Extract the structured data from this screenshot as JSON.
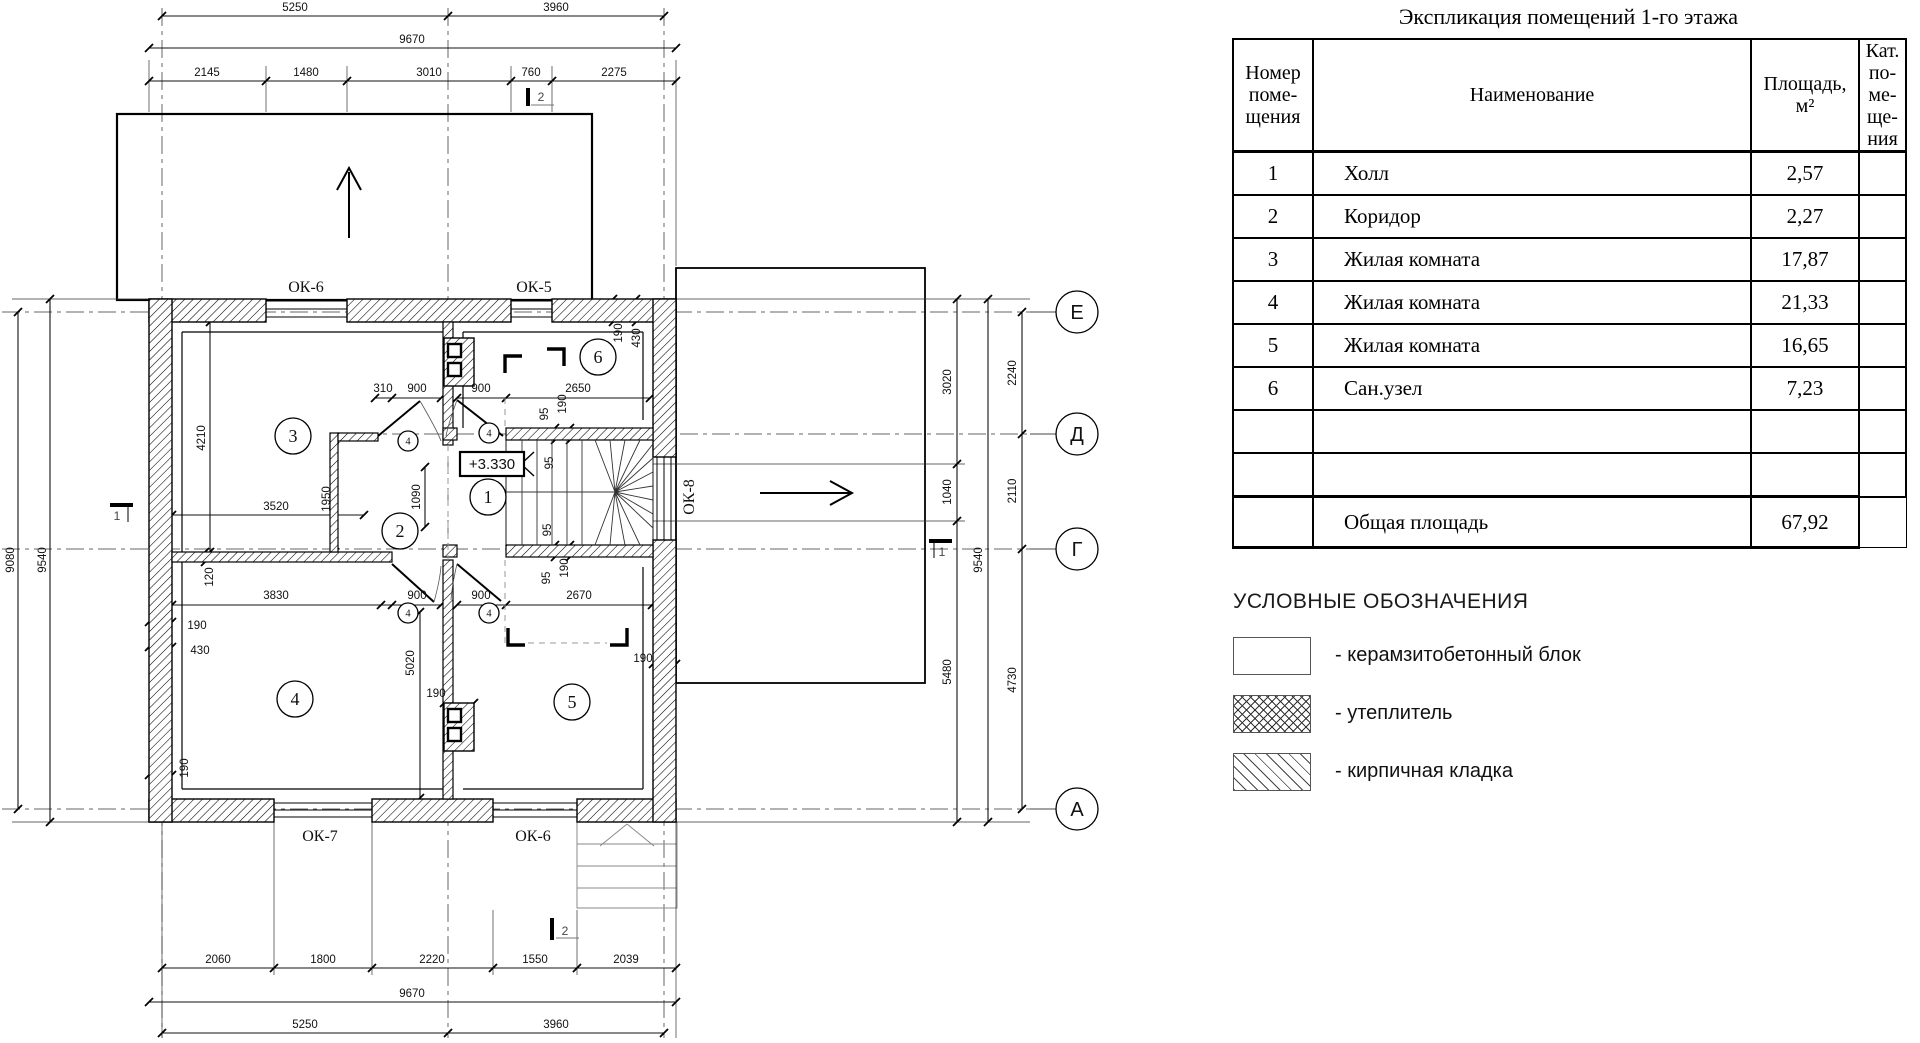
{
  "spec": {
    "title": "Экспликация помещений 1-го этажа",
    "headers": {
      "num": [
        "Номер",
        "поме-",
        "щения"
      ],
      "name": [
        "Наименование"
      ],
      "area": [
        "Площадь,",
        "м²"
      ],
      "cat": [
        "Кат.",
        "по-",
        "ме-",
        "ще-",
        "ния"
      ]
    },
    "rows": [
      {
        "num": "1",
        "name": "Холл",
        "area": "2,57",
        "cat": ""
      },
      {
        "num": "2",
        "name": "Коридор",
        "area": "2,27",
        "cat": ""
      },
      {
        "num": "3",
        "name": "Жилая комната",
        "area": "17,87",
        "cat": ""
      },
      {
        "num": "4",
        "name": "Жилая комната",
        "area": "21,33",
        "cat": ""
      },
      {
        "num": "5",
        "name": "Жилая комната",
        "area": "16,65",
        "cat": ""
      },
      {
        "num": "6",
        "name": "Сан.узел",
        "area": "7,23",
        "cat": ""
      },
      {
        "num": "",
        "name": "",
        "area": "",
        "cat": ""
      },
      {
        "num": "",
        "name": "",
        "area": "",
        "cat": ""
      }
    ],
    "total": {
      "label": "Общая площадь",
      "area": "67,92"
    }
  },
  "legend": {
    "title": "УСЛОВНЫЕ ОБОЗНАЧЕНИЯ",
    "items": [
      {
        "pattern": "plain",
        "label": "- керамзитобетонный блок"
      },
      {
        "pattern": "crosshatch",
        "label": "- утеплитель"
      },
      {
        "pattern": "diagonal",
        "label": "- кирпичная кладка"
      }
    ]
  },
  "plan": {
    "level_mark": {
      "text": "+3.330",
      "x": 492,
      "y": 469
    },
    "window_labels": [
      {
        "text": "ОК-6",
        "x": 306,
        "y": 292,
        "rot": 0
      },
      {
        "text": "ОК-5",
        "x": 534,
        "y": 292,
        "rot": 0
      },
      {
        "text": "ОК-7",
        "x": 320,
        "y": 841,
        "rot": 0
      },
      {
        "text": "ОК-6",
        "x": 533,
        "y": 841,
        "rot": 0
      },
      {
        "text": "ОК-8",
        "x": 694,
        "y": 497,
        "rot": -90
      }
    ],
    "room_circles": [
      {
        "n": "1",
        "x": 488,
        "y": 497
      },
      {
        "n": "2",
        "x": 400,
        "y": 531
      },
      {
        "n": "3",
        "x": 293,
        "y": 436
      },
      {
        "n": "4",
        "x": 295,
        "y": 699
      },
      {
        "n": "5",
        "x": 572,
        "y": 702
      },
      {
        "n": "6",
        "x": 598,
        "y": 357
      }
    ],
    "door_circles": [
      {
        "n": "4",
        "x": 408,
        "y": 441
      },
      {
        "n": "4",
        "x": 489,
        "y": 433
      },
      {
        "n": "4",
        "x": 408,
        "y": 613
      },
      {
        "n": "4",
        "x": 489,
        "y": 613
      }
    ],
    "axis_circles": [
      {
        "label": "Е",
        "x": 1077,
        "y": 312
      },
      {
        "label": "Д",
        "x": 1077,
        "y": 434
      },
      {
        "label": "Г",
        "x": 1077,
        "y": 549
      },
      {
        "label": "А",
        "x": 1077,
        "y": 809
      }
    ],
    "section_marks": [
      {
        "n": "2",
        "x": 541,
        "y": 101
      },
      {
        "n": "2",
        "x": 565,
        "y": 935
      },
      {
        "n": "1",
        "x": 117,
        "y": 520
      },
      {
        "n": "1",
        "x": 942,
        "y": 556
      }
    ],
    "dim_labels": [
      {
        "t": "5250",
        "x": 295,
        "y": 11
      },
      {
        "t": "3960",
        "x": 556,
        "y": 11
      },
      {
        "t": "9670",
        "x": 412,
        "y": 43
      },
      {
        "t": "2145",
        "x": 207,
        "y": 76
      },
      {
        "t": "1480",
        "x": 306,
        "y": 76
      },
      {
        "t": "3010",
        "x": 429,
        "y": 76
      },
      {
        "t": "760",
        "x": 531,
        "y": 76
      },
      {
        "t": "2275",
        "x": 614,
        "y": 76
      },
      {
        "t": "2060",
        "x": 218,
        "y": 963
      },
      {
        "t": "1800",
        "x": 323,
        "y": 963
      },
      {
        "t": "2220",
        "x": 432,
        "y": 963
      },
      {
        "t": "1550",
        "x": 535,
        "y": 963
      },
      {
        "t": "2039",
        "x": 626,
        "y": 963
      },
      {
        "t": "9670",
        "x": 412,
        "y": 997
      },
      {
        "t": "5250",
        "x": 305,
        "y": 1028
      },
      {
        "t": "3960",
        "x": 556,
        "y": 1028
      },
      {
        "t": "9080",
        "x": 14,
        "y": 560,
        "r": -90
      },
      {
        "t": "9540",
        "x": 46,
        "y": 560,
        "r": -90
      },
      {
        "t": "3020",
        "x": 951,
        "y": 382,
        "r": -90
      },
      {
        "t": "1040",
        "x": 951,
        "y": 492,
        "r": -90
      },
      {
        "t": "5480",
        "x": 951,
        "y": 672,
        "r": -90
      },
      {
        "t": "9540",
        "x": 982,
        "y": 560,
        "r": -90
      },
      {
        "t": "2240",
        "x": 1016,
        "y": 373,
        "r": -90
      },
      {
        "t": "2110",
        "x": 1016,
        "y": 491,
        "r": -90
      },
      {
        "t": "4730",
        "x": 1016,
        "y": 680,
        "r": -90
      },
      {
        "t": "4210",
        "x": 205,
        "y": 438,
        "r": -90
      },
      {
        "t": "3520",
        "x": 276,
        "y": 510
      },
      {
        "t": "1950",
        "x": 330,
        "y": 499,
        "r": -90
      },
      {
        "t": "120",
        "x": 213,
        "y": 577,
        "r": -90
      },
      {
        "t": "310",
        "x": 383,
        "y": 392
      },
      {
        "t": "900",
        "x": 417,
        "y": 392
      },
      {
        "t": "900",
        "x": 481,
        "y": 392
      },
      {
        "t": "2650",
        "x": 578,
        "y": 392
      },
      {
        "t": "1090",
        "x": 420,
        "y": 497,
        "r": -90
      },
      {
        "t": "3830",
        "x": 276,
        "y": 599
      },
      {
        "t": "900",
        "x": 417,
        "y": 599
      },
      {
        "t": "900",
        "x": 481,
        "y": 599
      },
      {
        "t": "2670",
        "x": 579,
        "y": 599
      },
      {
        "t": "5020",
        "x": 414,
        "y": 663,
        "r": -90
      },
      {
        "t": "190",
        "x": 436,
        "y": 697
      },
      {
        "t": "190",
        "x": 197,
        "y": 629
      },
      {
        "t": "430",
        "x": 200,
        "y": 654
      },
      {
        "t": "190",
        "x": 188,
        "y": 768,
        "r": -90
      },
      {
        "t": "190",
        "x": 622,
        "y": 333,
        "r": -90
      },
      {
        "t": "430",
        "x": 640,
        "y": 338,
        "r": -90
      },
      {
        "t": "190",
        "x": 643,
        "y": 662
      },
      {
        "t": "95",
        "x": 548,
        "y": 414,
        "r": -90
      },
      {
        "t": "190",
        "x": 566,
        "y": 404,
        "r": -90
      },
      {
        "t": "95",
        "x": 553,
        "y": 463,
        "r": -90
      },
      {
        "t": "95",
        "x": 551,
        "y": 530,
        "r": -90
      },
      {
        "t": "95",
        "x": 550,
        "y": 578,
        "r": -90
      },
      {
        "t": "190",
        "x": 568,
        "y": 568,
        "r": -90
      }
    ]
  }
}
